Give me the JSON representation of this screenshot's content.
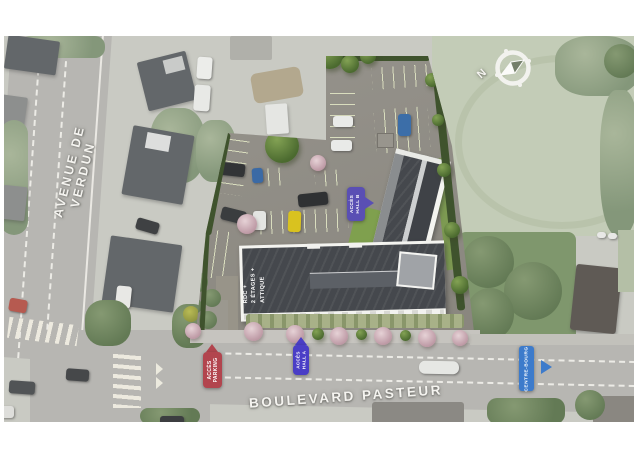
{
  "streets": {
    "avenue": "AVENUE DE VERDUN",
    "boulevard": "BOULEVARD PASTEUR"
  },
  "access_labels": {
    "parking": {
      "line1": "ACCÈS",
      "line2": "PARKING",
      "color": "#b2454e"
    },
    "hall_a": {
      "line1": "ACCÈS",
      "line2": "HALL A",
      "color": "#4a3ec6"
    },
    "hall_b": {
      "line1": "ACCÈS",
      "line2": "HALL B",
      "color": "#5a4fb4"
    },
    "centre_bourg": {
      "text": "CENTRE-BOURG",
      "color": "#3d7bcb"
    }
  },
  "building_label": {
    "line1": "RDC +",
    "line2": "2 ÉTAGES +",
    "line3": "ATTIQUE"
  },
  "compass": {
    "letter": "N"
  },
  "palette": {
    "roof_dark": "#45484d",
    "parking_pavers": "#a2a75a",
    "hedge_green": "#3f532d",
    "road_gray": "#b7b6b2",
    "field_green": "#c3ccb7"
  }
}
